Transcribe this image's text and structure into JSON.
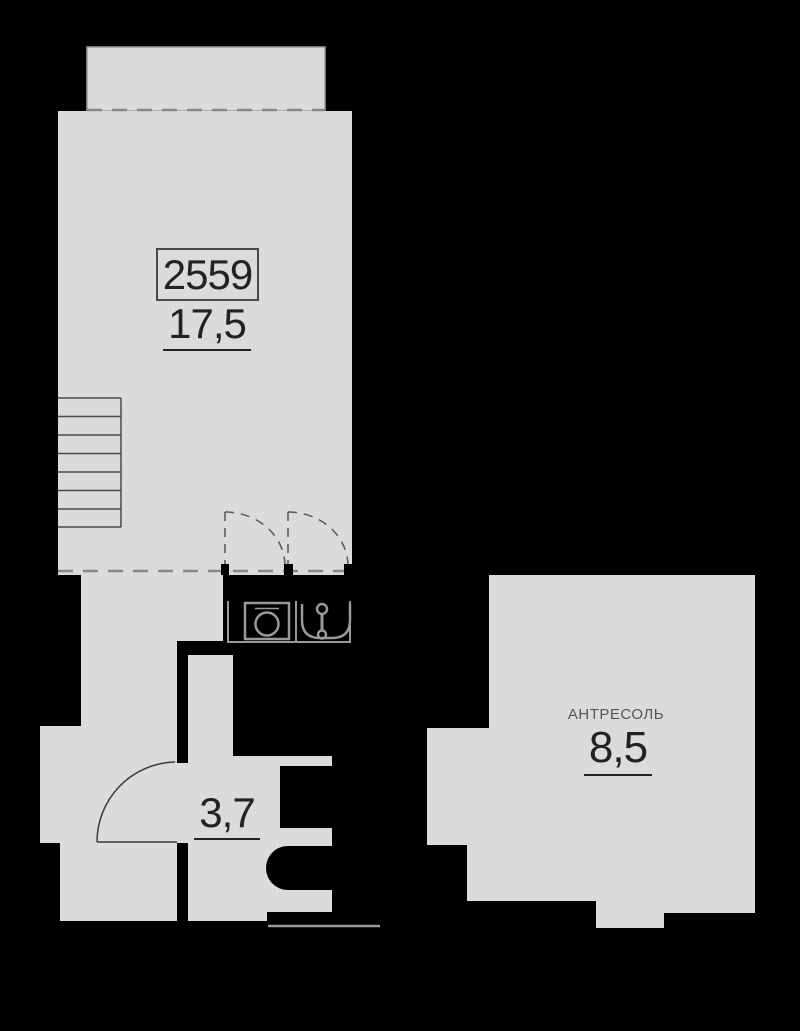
{
  "plan": {
    "unit_number": "2559",
    "rooms": {
      "main": {
        "area": "17,5"
      },
      "hall": {
        "area": "3,7"
      },
      "mezzanine": {
        "label": "АНТРЕСОЛЬ",
        "area": "8,5"
      }
    },
    "colors": {
      "background": "#000000",
      "floor": "#dbdbdb",
      "wall": "#000000",
      "outline": "#999999",
      "dashed_line": "#888888",
      "text": "#222222",
      "secondary_text": "#555555"
    }
  }
}
